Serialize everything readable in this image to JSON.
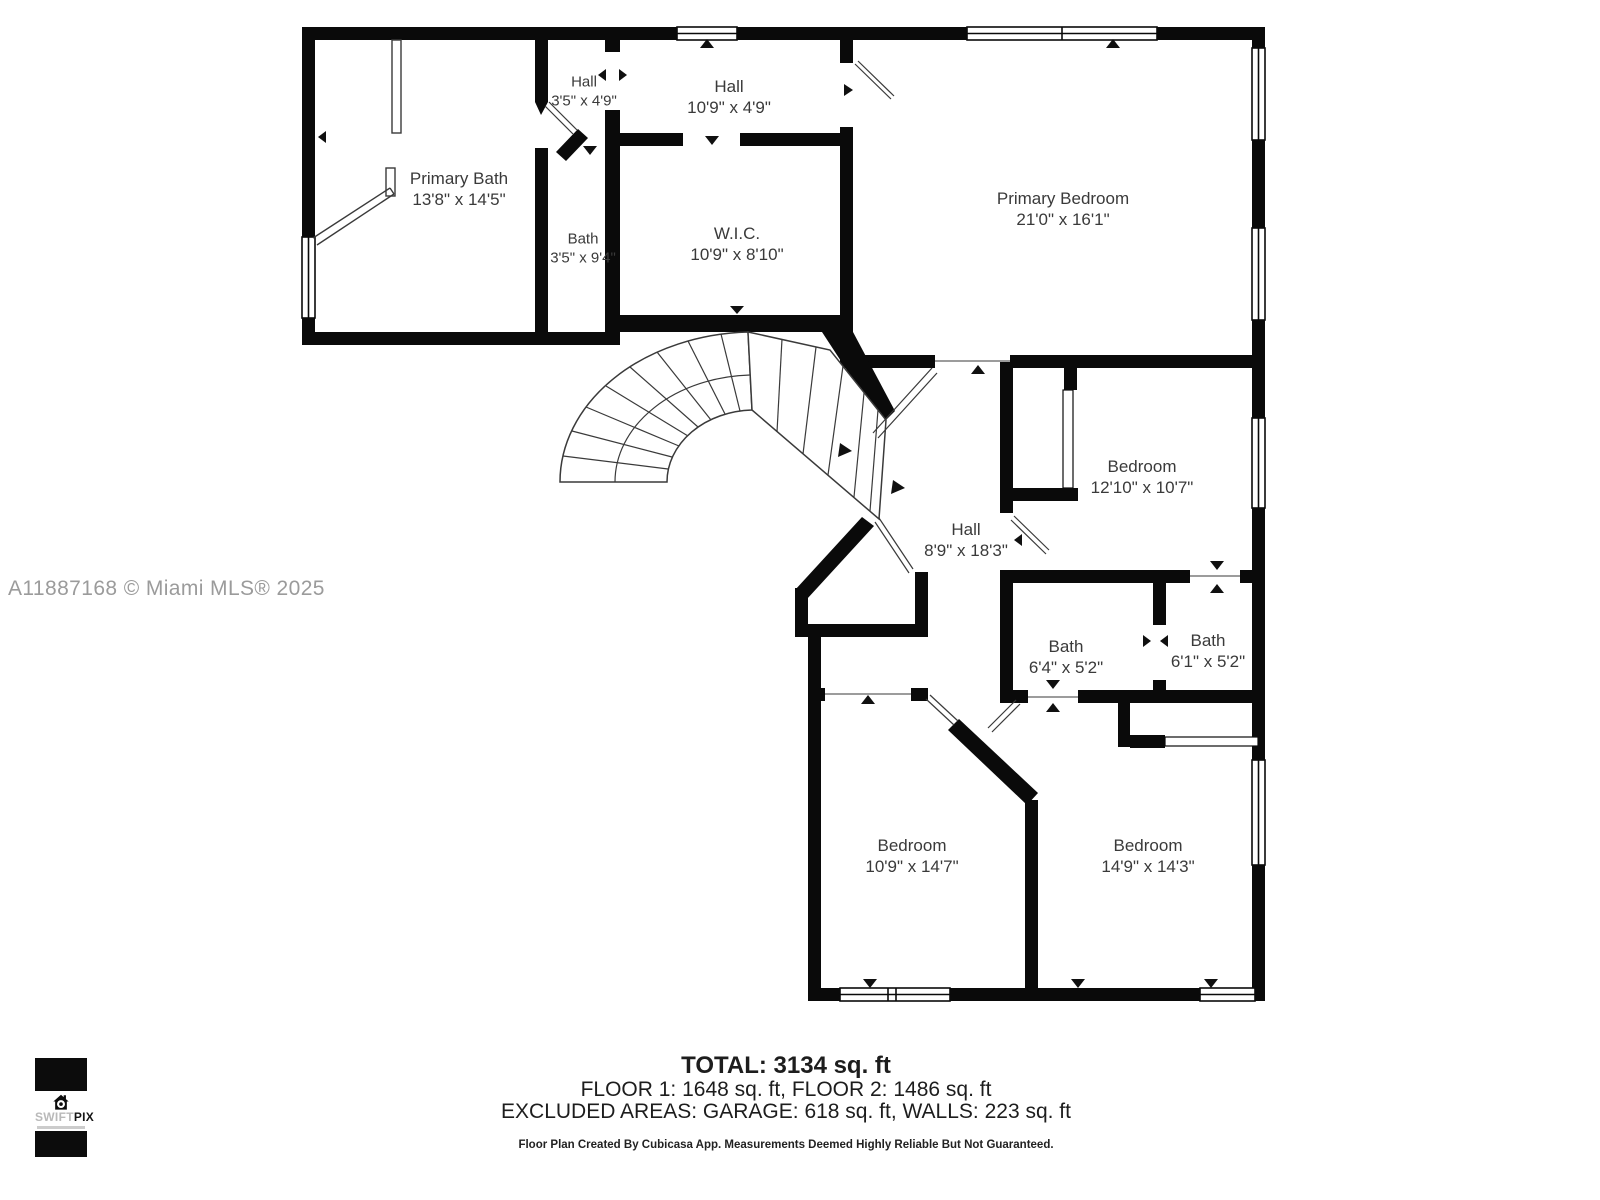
{
  "colors": {
    "wall": "#0a0a0a",
    "thin_line": "#3a3a3a",
    "label_text": "#3a3a3a",
    "watermark": "#9b9b9b",
    "footer_text": "#1d1d1d",
    "background": "#ffffff",
    "logo_black": "#0c0c0c",
    "logo_gray": "#b9b9b9"
  },
  "watermark": {
    "text": "A11887168 © Miami MLS® 2025"
  },
  "rooms": [
    {
      "id": "hall-upper-small",
      "name": "Hall",
      "dims": "3'5\" x 4'9\""
    },
    {
      "id": "hall-upper",
      "name": "Hall",
      "dims": "10'9\" x 4'9\""
    },
    {
      "id": "primary-bath",
      "name": "Primary Bath",
      "dims": "13'8\" x 14'5\""
    },
    {
      "id": "bath-small",
      "name": "Bath",
      "dims": "3'5\" x 9'4\""
    },
    {
      "id": "walk-in-closet",
      "name": "W.I.C.",
      "dims": "10'9\" x 8'10\""
    },
    {
      "id": "primary-bedroom",
      "name": "Primary Bedroom",
      "dims": "21'0\" x 16'1\""
    },
    {
      "id": "bedroom-east",
      "name": "Bedroom",
      "dims": "12'10\" x 10'7\""
    },
    {
      "id": "hall-main",
      "name": "Hall",
      "dims": "8'9\" x 18'3\""
    },
    {
      "id": "bath-west",
      "name": "Bath",
      "dims": "6'4\" x 5'2\""
    },
    {
      "id": "bath-east",
      "name": "Bath",
      "dims": "6'1\" x 5'2\""
    },
    {
      "id": "bedroom-southwest",
      "name": "Bedroom",
      "dims": "10'9\" x 14'7\""
    },
    {
      "id": "bedroom-southeast",
      "name": "Bedroom",
      "dims": "14'9\" x 14'3\""
    }
  ],
  "summary": {
    "total": "TOTAL: 3134 sq. ft",
    "floors": "FLOOR 1: 1648 sq. ft, FLOOR 2: 1486 sq. ft",
    "excluded": "EXCLUDED AREAS: GARAGE: 618 sq. ft, WALLS: 223 sq. ft",
    "disclaimer": "Floor Plan Created By Cubicasa App. Measurements Deemed Highly Reliable But Not Guaranteed."
  },
  "logo": {
    "brand_light": "SWIFT",
    "brand_bold": "PIX"
  }
}
